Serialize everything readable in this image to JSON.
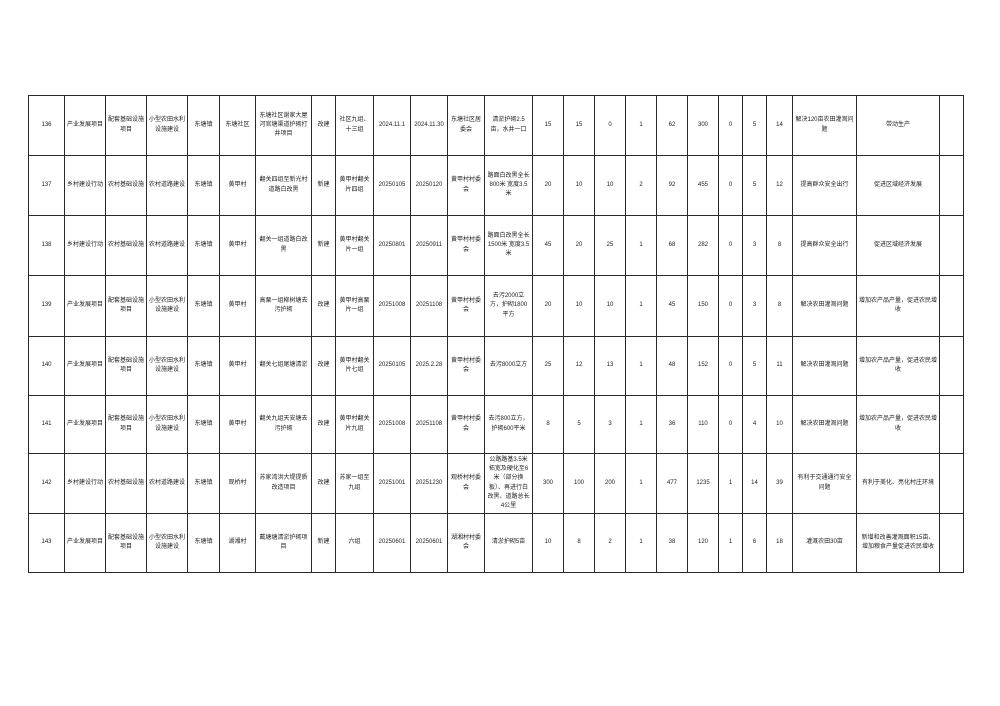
{
  "document": {
    "type": "project-schedule-table-page",
    "visible_row_range": "136-143"
  },
  "table": {
    "rows": [
      {
        "cells": [
          "136",
          "产业发展项目",
          "配套基础设施项目",
          "小型农田水利设施建设",
          "东塘镇",
          "东塘社区",
          "东塘社区谢家大屋河官塘渠道护砌打井项目",
          "改建",
          "社区九组、十三组",
          "2024.11.1",
          "2024.11.30",
          "东塘社区居委会",
          "清淤护砌2.5亩，水井一口",
          "15",
          "15",
          "0",
          "1",
          "62",
          "300",
          "0",
          "5",
          "14",
          "解决120亩农田灌溉问题",
          "带动生产",
          ""
        ]
      },
      {
        "cells": [
          "137",
          "乡村建设行动",
          "农村基础设施",
          "农村道路建设",
          "东塘镇",
          "黄甲村",
          "翻关四组至新光村道路白改黑",
          "新建",
          "黄甲村翻关片四组",
          "20250105",
          "20250120",
          "黄甲村村委会",
          "路面白改黑全长800米 宽度3.5米",
          "20",
          "10",
          "10",
          "2",
          "92",
          "455",
          "0",
          "5",
          "12",
          "提高群众安全出行",
          "促进区域经济发展",
          ""
        ]
      },
      {
        "cells": [
          "138",
          "乡村建设行动",
          "农村基础设施",
          "农村道路建设",
          "东塘镇",
          "黄甲村",
          "翻关一组道路白改黑",
          "新建",
          "黄甲村翻关片一组",
          "20250801",
          "20250911",
          "黄甲村村委会",
          "路面白改黑全长1500米 宽度3.5米",
          "45",
          "20",
          "25",
          "1",
          "68",
          "282",
          "0",
          "3",
          "8",
          "提高群众安全出行",
          "促进区域经济发展",
          ""
        ]
      },
      {
        "cells": [
          "139",
          "产业发展项目",
          "配套基础设施项目",
          "小型农田水利设施建设",
          "东塘镇",
          "黄甲村",
          "高栗一组柳树塘去污护砌",
          "改建",
          "黄甲村高栗片一组",
          "20251008",
          "20251108",
          "黄甲村村委会",
          "去污2000立方，护砌1800平方",
          "20",
          "10",
          "10",
          "1",
          "45",
          "150",
          "0",
          "3",
          "8",
          "解决农田灌溉问题",
          "增加农产品产量，促进农民增收",
          ""
        ]
      },
      {
        "cells": [
          "140",
          "产业发展项目",
          "配套基础设施项目",
          "小型农田水利设施建设",
          "东塘镇",
          "黄甲村",
          "翻关七组尾塘清淤",
          "改建",
          "黄甲村翻关片七组",
          "20250105",
          "2025.2.28",
          "黄甲村村委会",
          "去污8000立方",
          "25",
          "12",
          "13",
          "1",
          "48",
          "152",
          "0",
          "5",
          "11",
          "解决农田灌溉问题",
          "增加农产品产量，促进农民增收",
          ""
        ]
      },
      {
        "cells": [
          "141",
          "产业发展项目",
          "配套基础设施项目",
          "小型农田水利设施建设",
          "东塘镇",
          "黄甲村",
          "翻关九组天安塘去污护砌",
          "改建",
          "黄甲村翻关片九组",
          "20251008",
          "20251108",
          "黄甲村村委会",
          "去污800立方，护砌600平米",
          "8",
          "5",
          "3",
          "1",
          "36",
          "110",
          "0",
          "4",
          "10",
          "解决农田灌溉问题",
          "增加农产品产量，促进农民增收",
          ""
        ]
      },
      {
        "cells": [
          "142",
          "乡村建设行动",
          "农村基础设施",
          "农村道路建设",
          "东塘镇",
          "观桥村",
          "苏家湾洪大堤提质改造项目",
          "改建",
          "苏家一组至九组",
          "20251001",
          "20251230",
          "观桥村村委会",
          "公路路基3.5米拓宽及硬化至6米（部分换板）、再进行白改黑、道路总长4公里",
          "300",
          "100",
          "200",
          "1",
          "477",
          "1235",
          "1",
          "14",
          "39",
          "有利于交通通行安全问题",
          "有利于美化、亮化村庄环境",
          ""
        ]
      },
      {
        "cells": [
          "143",
          "产业发展项目",
          "配套基础设施项目",
          "小型农田水利设施建设",
          "东塘镇",
          "湖湘村",
          "戴塘塘清淤护砌项目",
          "新建",
          "六组",
          "20250601",
          "20250601",
          "湖湘村村委会",
          "清淤护砌5亩",
          "10",
          "8",
          "2",
          "1",
          "38",
          "120",
          "1",
          "6",
          "18",
          "灌溉农田30亩",
          "新增和改善灌溉面积15亩、增加粮食产量促进农民增收",
          ""
        ]
      }
    ]
  }
}
